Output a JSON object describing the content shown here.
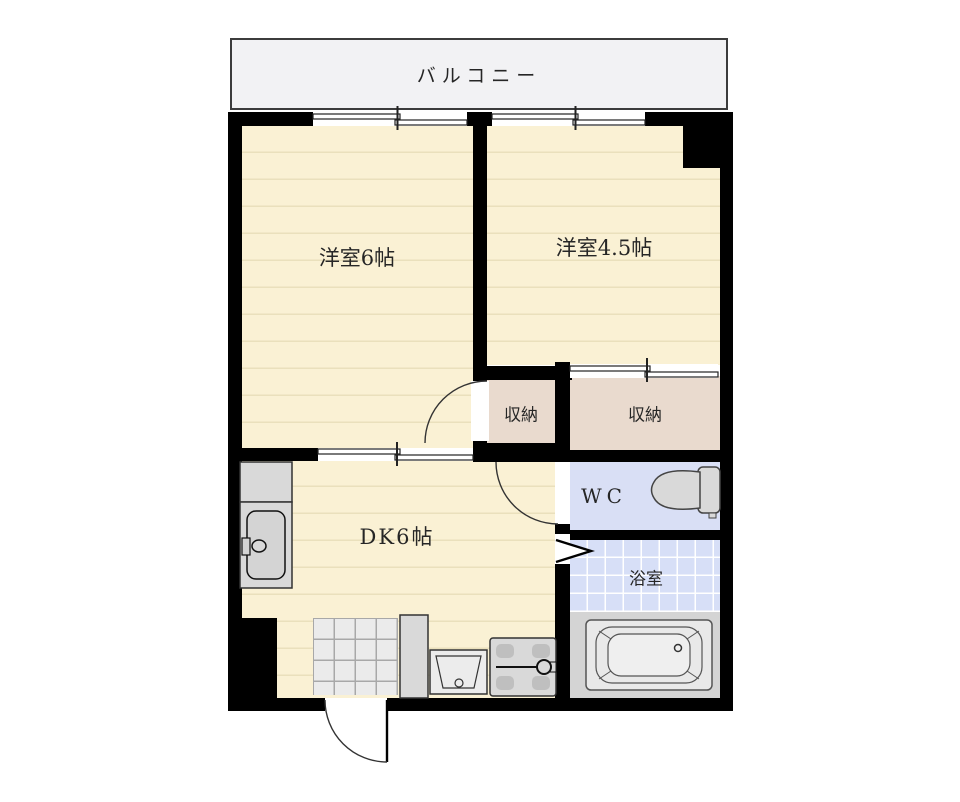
{
  "floor_plan": {
    "balcony": {
      "label": "バルコニー"
    },
    "rooms": {
      "western6": {
        "label": "洋室6帖"
      },
      "western45": {
        "label": "洋室4.5帖"
      },
      "storage_left": {
        "label": "収納"
      },
      "storage_right": {
        "label": "収納"
      },
      "wc": {
        "label": "WC"
      },
      "bath": {
        "label": "浴室"
      },
      "dk": {
        "label": "DK6帖"
      }
    },
    "fixtures": {
      "toilet": "toilet-icon",
      "bathtub": "bathtub-icon",
      "kitchen_sink": "kitchen-sink-icon",
      "washbasin": "washbasin-icon",
      "washing_machine_pan": "washing-machine-pan-icon",
      "shoe_cabinet": "shoe-cabinet-icon",
      "entrance_tiles": "entrance-tiles",
      "doors": [
        "hinged-door-swing-icon",
        "sliding-door-icon",
        "folding-door-icon",
        "entry-door-swing-icon"
      ],
      "windows": [
        "sliding-window-icon"
      ]
    },
    "colors": {
      "wall": "#000000",
      "room_floor": "#faf1d4",
      "room_floor_stripe": "#eae0bc",
      "storage_floor": "#e9dace",
      "wet_area": "#d9dff5",
      "bath_tile": "#d7dff7",
      "fixture_gray": "#d9d9d9",
      "entrance_tile": "#ebebeb",
      "balcony": "#f2f2f4",
      "background": "#ffffff"
    }
  }
}
